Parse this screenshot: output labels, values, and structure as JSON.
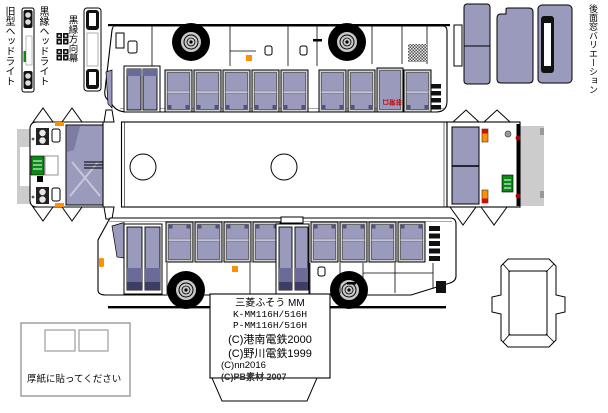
{
  "labels": {
    "old_headlight": "旧型ヘッドライト",
    "black_rim_headlight": "黒縁ヘッドライト",
    "black_rim_destination_sign": "黒縁方向幕",
    "rear_window_variation": "後面窓バリエーション",
    "emergency_exit": "非常口",
    "cardboard_instruction": "厚紙に貼ってください"
  },
  "spec_box": {
    "model_name": "三菱ふそう MM",
    "code_1": "K-MM116H/516H",
    "code_2": "P-MM116H/516H",
    "credit_1": "(C)港南電鉄2000",
    "credit_2": "(C)野川電鉄1999",
    "credit_3": "(C)nn2016",
    "credit_4": "(C)PB素材 2007"
  },
  "colors": {
    "window_glass": "#9a9abd",
    "window_dark": "#52527a",
    "door_glass_dark": "#6b6b99",
    "door_glass_darker": "#3d3d66",
    "marker_orange": "#ff9100",
    "tail_red": "#cc1100",
    "plate_green": "#0a8a14",
    "tab_gray": "#cccccc",
    "emergency_red": "#cc0000"
  }
}
